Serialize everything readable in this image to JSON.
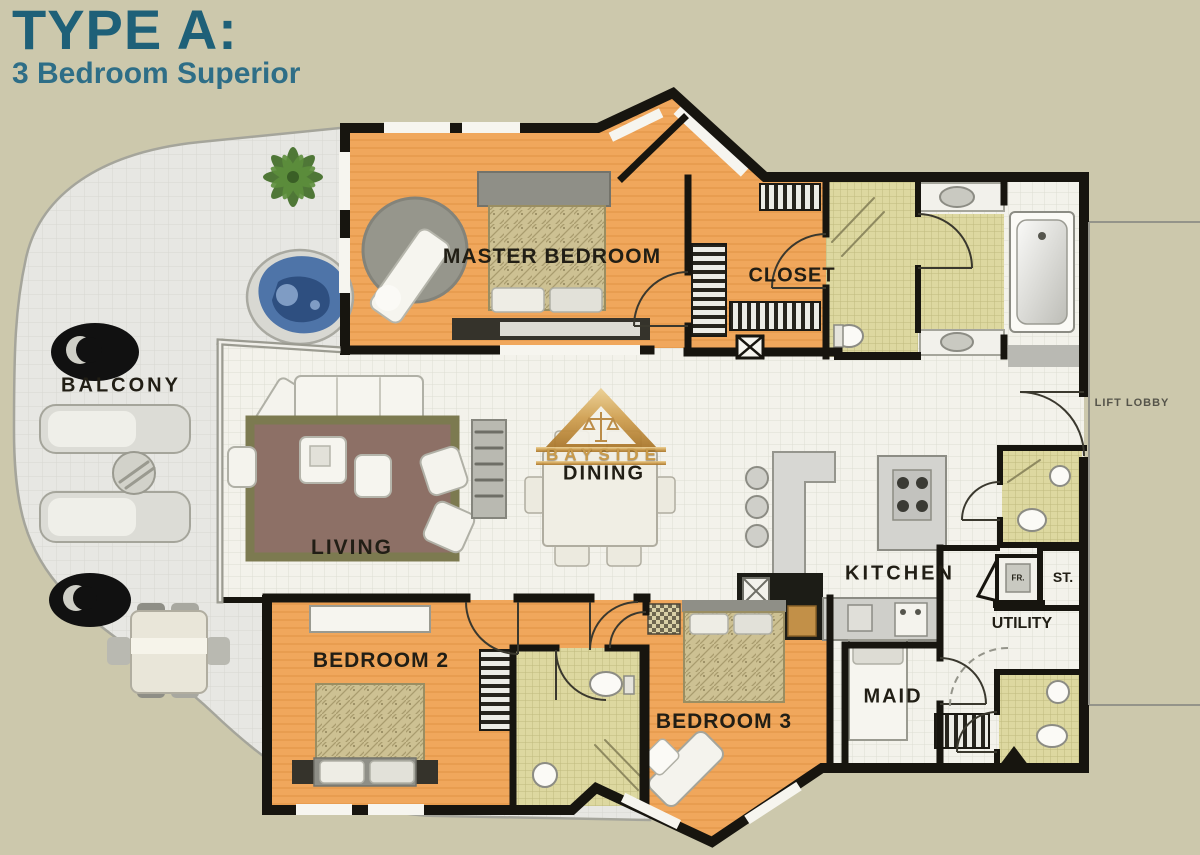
{
  "header": {
    "title": "TYPE A:",
    "subtitle": "3 Bedroom Superior"
  },
  "watermark": {
    "brand": "BAYSIDE"
  },
  "rooms": {
    "master_bedroom": "MASTER BEDROOM",
    "closet": "CLOSET",
    "balcony": "BALCONY",
    "living": "LIVING",
    "dining": "DINING",
    "kitchen": "KITCHEN",
    "bedroom2": "BEDROOM 2",
    "bedroom3": "BEDROOM 3",
    "maid": "MAID",
    "utility": "UTILITY",
    "store": "ST.",
    "fridge": "FR.",
    "lift_lobby": "LIFT LOBBY"
  },
  "colors": {
    "background_beige": "#ccc8ac",
    "title_teal": "#1e6078",
    "bedroom_orange": "#f0a75c",
    "bathroom_khaki": "#ddd8a0",
    "wall_black": "#17150f",
    "balcony_gray": "#e7e7e3",
    "rug_brown": "#8d7066",
    "rug_border_olive": "#7c7a50",
    "spa_blue": "#4e74a8",
    "palm_green": "#47722e",
    "logo_gold": "#c89a4b"
  }
}
